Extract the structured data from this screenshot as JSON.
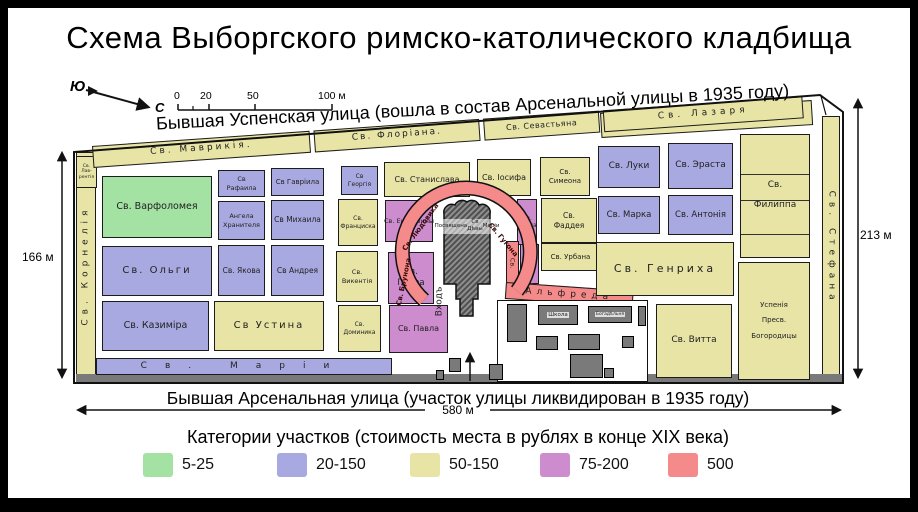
{
  "title": "Схема Выборгского римско-католического кладбища",
  "compass": {
    "south_label": "Ю",
    "north_label": "С"
  },
  "scale_bar": {
    "ticks": [
      {
        "label": "0",
        "x": 174
      },
      {
        "label": "20",
        "x": 200
      },
      {
        "label": "50",
        "x": 247
      },
      {
        "label": "100 м",
        "x": 318
      }
    ]
  },
  "streets": {
    "top": "Бывшая Успенская улица (вошла в состав Арсенальной улицы в 1935 году)",
    "bottom": "Бывшая Арсенальная улица (участок улицы ликвидирован в 1935 году)"
  },
  "measurements": {
    "left": "166 м",
    "right": "213 м",
    "bottom": "580 м"
  },
  "colors": {
    "green": "#a4e2a4",
    "blue": "#a9a9e1",
    "yellow": "#e8e4a6",
    "purple": "#cd8ccd",
    "red": "#f58a8a",
    "dark": "#7a7a7a",
    "white": "#ffffff",
    "line": "#333333"
  },
  "map": {
    "top_strip": {
      "x": 92,
      "y": 146,
      "w": 722,
      "h": 22,
      "rot": -4,
      "plots": [
        {
          "id": "mavrikiya",
          "label": "Св.  Маврикія.",
          "w": 218,
          "fs": 9,
          "ls": 3
        },
        {
          "id": "floriana",
          "label": "Св.  Флоріана.",
          "w": 166,
          "fs": 9,
          "ls": 2
        },
        {
          "id": "sevastyana",
          "label": "Св. Севастьяна",
          "w": 116,
          "fs": 8,
          "ls": 0.5
        },
        {
          "id": "lazarya",
          "label": "Св.  Лазаря",
          "w": 200,
          "fs": 9,
          "ls": 4
        }
      ]
    },
    "plots": [
      {
        "id": "ne-band",
        "cat": "yellow",
        "x": 600,
        "y": 113,
        "w": 212,
        "h": 25,
        "rot": -3.5
      },
      {
        "id": "kornelia",
        "cat": "yellow",
        "x": 76,
        "y": 152,
        "w": 20,
        "h": 228,
        "vert": "up",
        "label": "Св.  Корнелія",
        "fs": 9,
        "ls": 5
      },
      {
        "id": "lavrentiya",
        "cat": "yellow",
        "x": 76,
        "y": 156,
        "w": 21,
        "h": 32,
        "lines": [
          "Св.",
          "Лав-",
          "рентія"
        ],
        "fs": 4.5
      },
      {
        "id": "ioakima",
        "cat": "yellow",
        "x": 95,
        "y": 146,
        "w": 44,
        "h": 17,
        "lines": [
          "Св.",
          "Іоакима"
        ],
        "fs": 5
      },
      {
        "id": "stefana",
        "cat": "yellow",
        "x": 822,
        "y": 116,
        "w": 18,
        "h": 264,
        "vert": "down",
        "label": "Св.  Стефана",
        "fs": 9,
        "ls": 5
      },
      {
        "id": "bottom-band",
        "cat": "dark",
        "cls": "bldg bare",
        "x": 76,
        "y": 374,
        "w": 766,
        "h": 9
      },
      {
        "id": "marii",
        "cat": "blue",
        "x": 96,
        "y": 358,
        "w": 296,
        "h": 17,
        "label": "Св.  Маріи",
        "fs": 9,
        "ls": 18
      },
      {
        "id": "varfolomeya",
        "cat": "green",
        "x": 102,
        "y": 176,
        "w": 110,
        "h": 62,
        "label": "Св.  Варфоломея",
        "fs": 9.5
      },
      {
        "id": "rafaila",
        "cat": "blue",
        "x": 218,
        "y": 170,
        "w": 47,
        "h": 27,
        "lines": [
          "Св",
          "Рафаила"
        ],
        "fs": 6.5
      },
      {
        "id": "gavriila",
        "cat": "blue",
        "x": 271,
        "y": 168,
        "w": 53,
        "h": 28,
        "label": "Св Гавріила",
        "fs": 7
      },
      {
        "id": "angela",
        "cat": "blue",
        "x": 218,
        "y": 201,
        "w": 47,
        "h": 39,
        "lines": [
          "Ангела",
          "Хранителя"
        ],
        "fs": 6.5
      },
      {
        "id": "mikhaila",
        "cat": "blue",
        "x": 271,
        "y": 200,
        "w": 53,
        "h": 40,
        "label": "Св Михаила",
        "fs": 7.5
      },
      {
        "id": "olgi",
        "cat": "blue",
        "x": 102,
        "y": 246,
        "w": 110,
        "h": 50,
        "label": "Св. Ольги",
        "fs": 10,
        "ls": 2
      },
      {
        "id": "yakova",
        "cat": "blue",
        "x": 218,
        "y": 245,
        "w": 47,
        "h": 51,
        "label": "Св. Якова",
        "fs": 7.5
      },
      {
        "id": "andreya",
        "cat": "blue",
        "x": 271,
        "y": 245,
        "w": 53,
        "h": 51,
        "label": "Св Андрея",
        "fs": 7.5
      },
      {
        "id": "kazimira",
        "cat": "blue",
        "x": 102,
        "y": 301,
        "w": 107,
        "h": 50,
        "label": "Св. Казиміра",
        "fs": 9.5
      },
      {
        "id": "ustina",
        "cat": "yellow",
        "x": 214,
        "y": 301,
        "w": 110,
        "h": 50,
        "label": "Св  Устина",
        "fs": 10,
        "ls": 2
      },
      {
        "id": "georgiya",
        "cat": "blue",
        "x": 341,
        "y": 166,
        "w": 37,
        "h": 29,
        "lines": [
          "Св",
          "Георгія"
        ],
        "fs": 6
      },
      {
        "id": "stanislava",
        "cat": "yellow",
        "x": 384,
        "y": 162,
        "w": 86,
        "h": 35,
        "label": "Св. Станислава",
        "fs": 8
      },
      {
        "id": "iosifa",
        "cat": "yellow",
        "x": 477,
        "y": 159,
        "w": 54,
        "h": 37,
        "label": "Св. Іосифа",
        "fs": 8
      },
      {
        "id": "simeona",
        "cat": "yellow",
        "x": 540,
        "y": 157,
        "w": 50,
        "h": 39,
        "lines": [
          "Св.",
          "Симеона"
        ],
        "fs": 7
      },
      {
        "id": "frantsiska",
        "cat": "yellow",
        "x": 338,
        "y": 199,
        "w": 40,
        "h": 47,
        "lines": [
          "Св.",
          "Франциска"
        ],
        "fs": 6
      },
      {
        "id": "ekateriny",
        "cat": "purple",
        "x": 385,
        "y": 200,
        "w": 48,
        "h": 42,
        "label": "Св. Екатерины",
        "fs": 6.5
      },
      {
        "id": "karla",
        "cat": "purple",
        "x": 517,
        "y": 199,
        "w": 20,
        "h": 46,
        "lines": [
          "Св.",
          "Карла"
        ],
        "fs": 6
      },
      {
        "id": "faddeya",
        "cat": "yellow",
        "x": 541,
        "y": 198,
        "w": 56,
        "h": 45,
        "lines": [
          "Св.",
          "Фаддея"
        ],
        "fs": 7.5
      },
      {
        "id": "vikentiya",
        "cat": "yellow",
        "x": 336,
        "y": 251,
        "w": 42,
        "h": 51,
        "lines": [
          "Св.",
          "Викентія"
        ],
        "fs": 6.5
      },
      {
        "id": "petra",
        "cat": "purple",
        "x": 388,
        "y": 252,
        "w": 46,
        "h": 52,
        "lines": [
          "Св.",
          "Петра"
        ],
        "fs": 8.5
      },
      {
        "id": "ioann",
        "cat": "purple",
        "x": 520,
        "y": 244,
        "w": 19,
        "h": 40,
        "lines": [
          "Св.",
          "Іоанн"
        ],
        "fs": 5
      },
      {
        "id": "urbana",
        "cat": "yellow",
        "x": 541,
        "y": 243,
        "w": 59,
        "h": 28,
        "label": "Св. Урбана",
        "fs": 7
      },
      {
        "id": "alfreda-sv",
        "cat": "red",
        "x": 506,
        "y": 241,
        "w": 13,
        "h": 44,
        "vert": "down",
        "label": "Св.",
        "fs": 6.5
      },
      {
        "id": "alfreda",
        "cat": "red",
        "x": 506,
        "y": 282,
        "w": 128,
        "h": 17,
        "rot": 4,
        "label": "Альфреда",
        "fs": 9,
        "ls": 5
      },
      {
        "id": "dominika",
        "cat": "yellow",
        "x": 338,
        "y": 305,
        "w": 43,
        "h": 47,
        "lines": [
          "Св.",
          "Доминика"
        ],
        "fs": 6
      },
      {
        "id": "pavla",
        "cat": "purple",
        "x": 389,
        "y": 305,
        "w": 59,
        "h": 48,
        "label": "Св. Павла",
        "fs": 8
      },
      {
        "id": "luki",
        "cat": "blue",
        "x": 598,
        "y": 146,
        "w": 62,
        "h": 42,
        "label": "Св. Луки",
        "fs": 9
      },
      {
        "id": "erasta",
        "cat": "blue",
        "x": 668,
        "y": 143,
        "w": 65,
        "h": 46,
        "label": "Св. Эраста",
        "fs": 9
      },
      {
        "id": "marka",
        "cat": "blue",
        "x": 598,
        "y": 196,
        "w": 62,
        "h": 38,
        "label": "Св. Марка",
        "fs": 8.5
      },
      {
        "id": "antoniya",
        "cat": "blue",
        "x": 668,
        "y": 195,
        "w": 65,
        "h": 40,
        "label": "Св. Антонія",
        "fs": 8.5
      },
      {
        "id": "genrikha",
        "cat": "yellow",
        "x": 596,
        "y": 242,
        "w": 138,
        "h": 54,
        "label": "Св.  Генриха",
        "fs": 11,
        "ls": 3
      },
      {
        "id": "filippa",
        "cat": "yellow",
        "cls": "gapped",
        "x": 740,
        "y": 134,
        "w": 70,
        "h": 124,
        "lines": [
          "Св.",
          "Филиппа"
        ],
        "fs": 9
      },
      {
        "id": "filippa-line1",
        "cat": "line",
        "cls": "bare",
        "x": 741,
        "y": 174,
        "w": 68,
        "h": 1
      },
      {
        "id": "filippa-line2",
        "cat": "line",
        "cls": "bare",
        "x": 741,
        "y": 200,
        "w": 68,
        "h": 1
      },
      {
        "id": "filippa-line3",
        "cat": "line",
        "cls": "bare",
        "x": 741,
        "y": 234,
        "w": 68,
        "h": 1
      },
      {
        "id": "uspeniya",
        "cat": "yellow",
        "cls": "gapped",
        "x": 738,
        "y": 262,
        "w": 72,
        "h": 118,
        "lines": [
          "Успенія",
          "Пресв.",
          "Богородицы"
        ],
        "fs": 7
      },
      {
        "id": "vitta",
        "cat": "yellow",
        "x": 656,
        "y": 304,
        "w": 76,
        "h": 74,
        "label": "Св. Витта",
        "fs": 9
      },
      {
        "id": "courtyard",
        "cat": "white",
        "cls": "yard",
        "x": 497,
        "y": 300,
        "w": 151,
        "h": 82
      },
      {
        "id": "bldg-vert",
        "cat": "dark",
        "cls": "bldg",
        "x": 507,
        "y": 304,
        "w": 20,
        "h": 38
      },
      {
        "id": "school",
        "cat": "dark",
        "cls": "bldg",
        "x": 538,
        "y": 305,
        "w": 40,
        "h": 20,
        "label": "Школа",
        "fs": 5.5
      },
      {
        "id": "almshouse",
        "cat": "dark",
        "cls": "bldg",
        "x": 588,
        "y": 306,
        "w": 44,
        "h": 17,
        "label": "Богадѣльня",
        "fs": 4.5
      },
      {
        "id": "bldg-1",
        "cat": "dark",
        "cls": "bldg",
        "x": 536,
        "y": 336,
        "w": 22,
        "h": 14
      },
      {
        "id": "bldg-2",
        "cat": "dark",
        "cls": "bldg",
        "x": 568,
        "y": 334,
        "w": 32,
        "h": 16
      },
      {
        "id": "bldg-3",
        "cat": "dark",
        "cls": "bldg",
        "x": 622,
        "y": 336,
        "w": 12,
        "h": 12
      },
      {
        "id": "bldg-4",
        "cat": "dark",
        "cls": "bldg",
        "x": 570,
        "y": 354,
        "w": 33,
        "h": 24
      },
      {
        "id": "bldg-5",
        "cat": "dark",
        "cls": "bldg",
        "x": 604,
        "y": 368,
        "w": 10,
        "h": 10
      },
      {
        "id": "bldg-6",
        "cat": "dark",
        "cls": "bldg",
        "x": 449,
        "y": 358,
        "w": 12,
        "h": 14
      },
      {
        "id": "bldg-7",
        "cat": "dark",
        "cls": "bldg",
        "x": 489,
        "y": 364,
        "w": 14,
        "h": 16
      },
      {
        "id": "bldg-8",
        "cat": "dark",
        "cls": "bldg",
        "x": 638,
        "y": 306,
        "w": 8,
        "h": 20
      },
      {
        "id": "bldg-9",
        "cat": "dark",
        "cls": "bldg",
        "x": 436,
        "y": 370,
        "w": 8,
        "h": 10
      }
    ],
    "chapel": {
      "x": 441,
      "y": 219,
      "w": 52,
      "fs": 5.5,
      "lines": [
        "Посвящена",
        "Св Дѣвы",
        "Маріи"
      ]
    },
    "arc_labels": [
      {
        "id": "lyudovika",
        "text": "Св. Людовика",
        "x": 399,
        "y": 253,
        "w": 74,
        "rot": -54,
        "fs": 7
      },
      {
        "id": "gugona",
        "text": "Св. Гугона",
        "x": 483,
        "y": 212,
        "w": 62,
        "rot": 50,
        "fs": 7
      },
      {
        "id": "brunona",
        "text": "Св. Брунона",
        "x": 398,
        "y": 306,
        "w": 58,
        "rot": -78,
        "fs": 7
      }
    ],
    "entrance": {
      "text": "Входъ",
      "x": 440,
      "y": 324,
      "w": 56,
      "rot": -90,
      "fs": 9
    }
  },
  "legend": {
    "title": "Категории участков (стоимость места в рублях в конце XIX века)",
    "items": [
      {
        "range": "5-25",
        "category": "green",
        "x": 143
      },
      {
        "range": "20-150",
        "category": "blue",
        "x": 277
      },
      {
        "range": "50-150",
        "category": "yellow",
        "x": 410
      },
      {
        "range": "75-200",
        "category": "purple",
        "x": 540
      },
      {
        "range": "500",
        "category": "red",
        "x": 668
      }
    ]
  }
}
